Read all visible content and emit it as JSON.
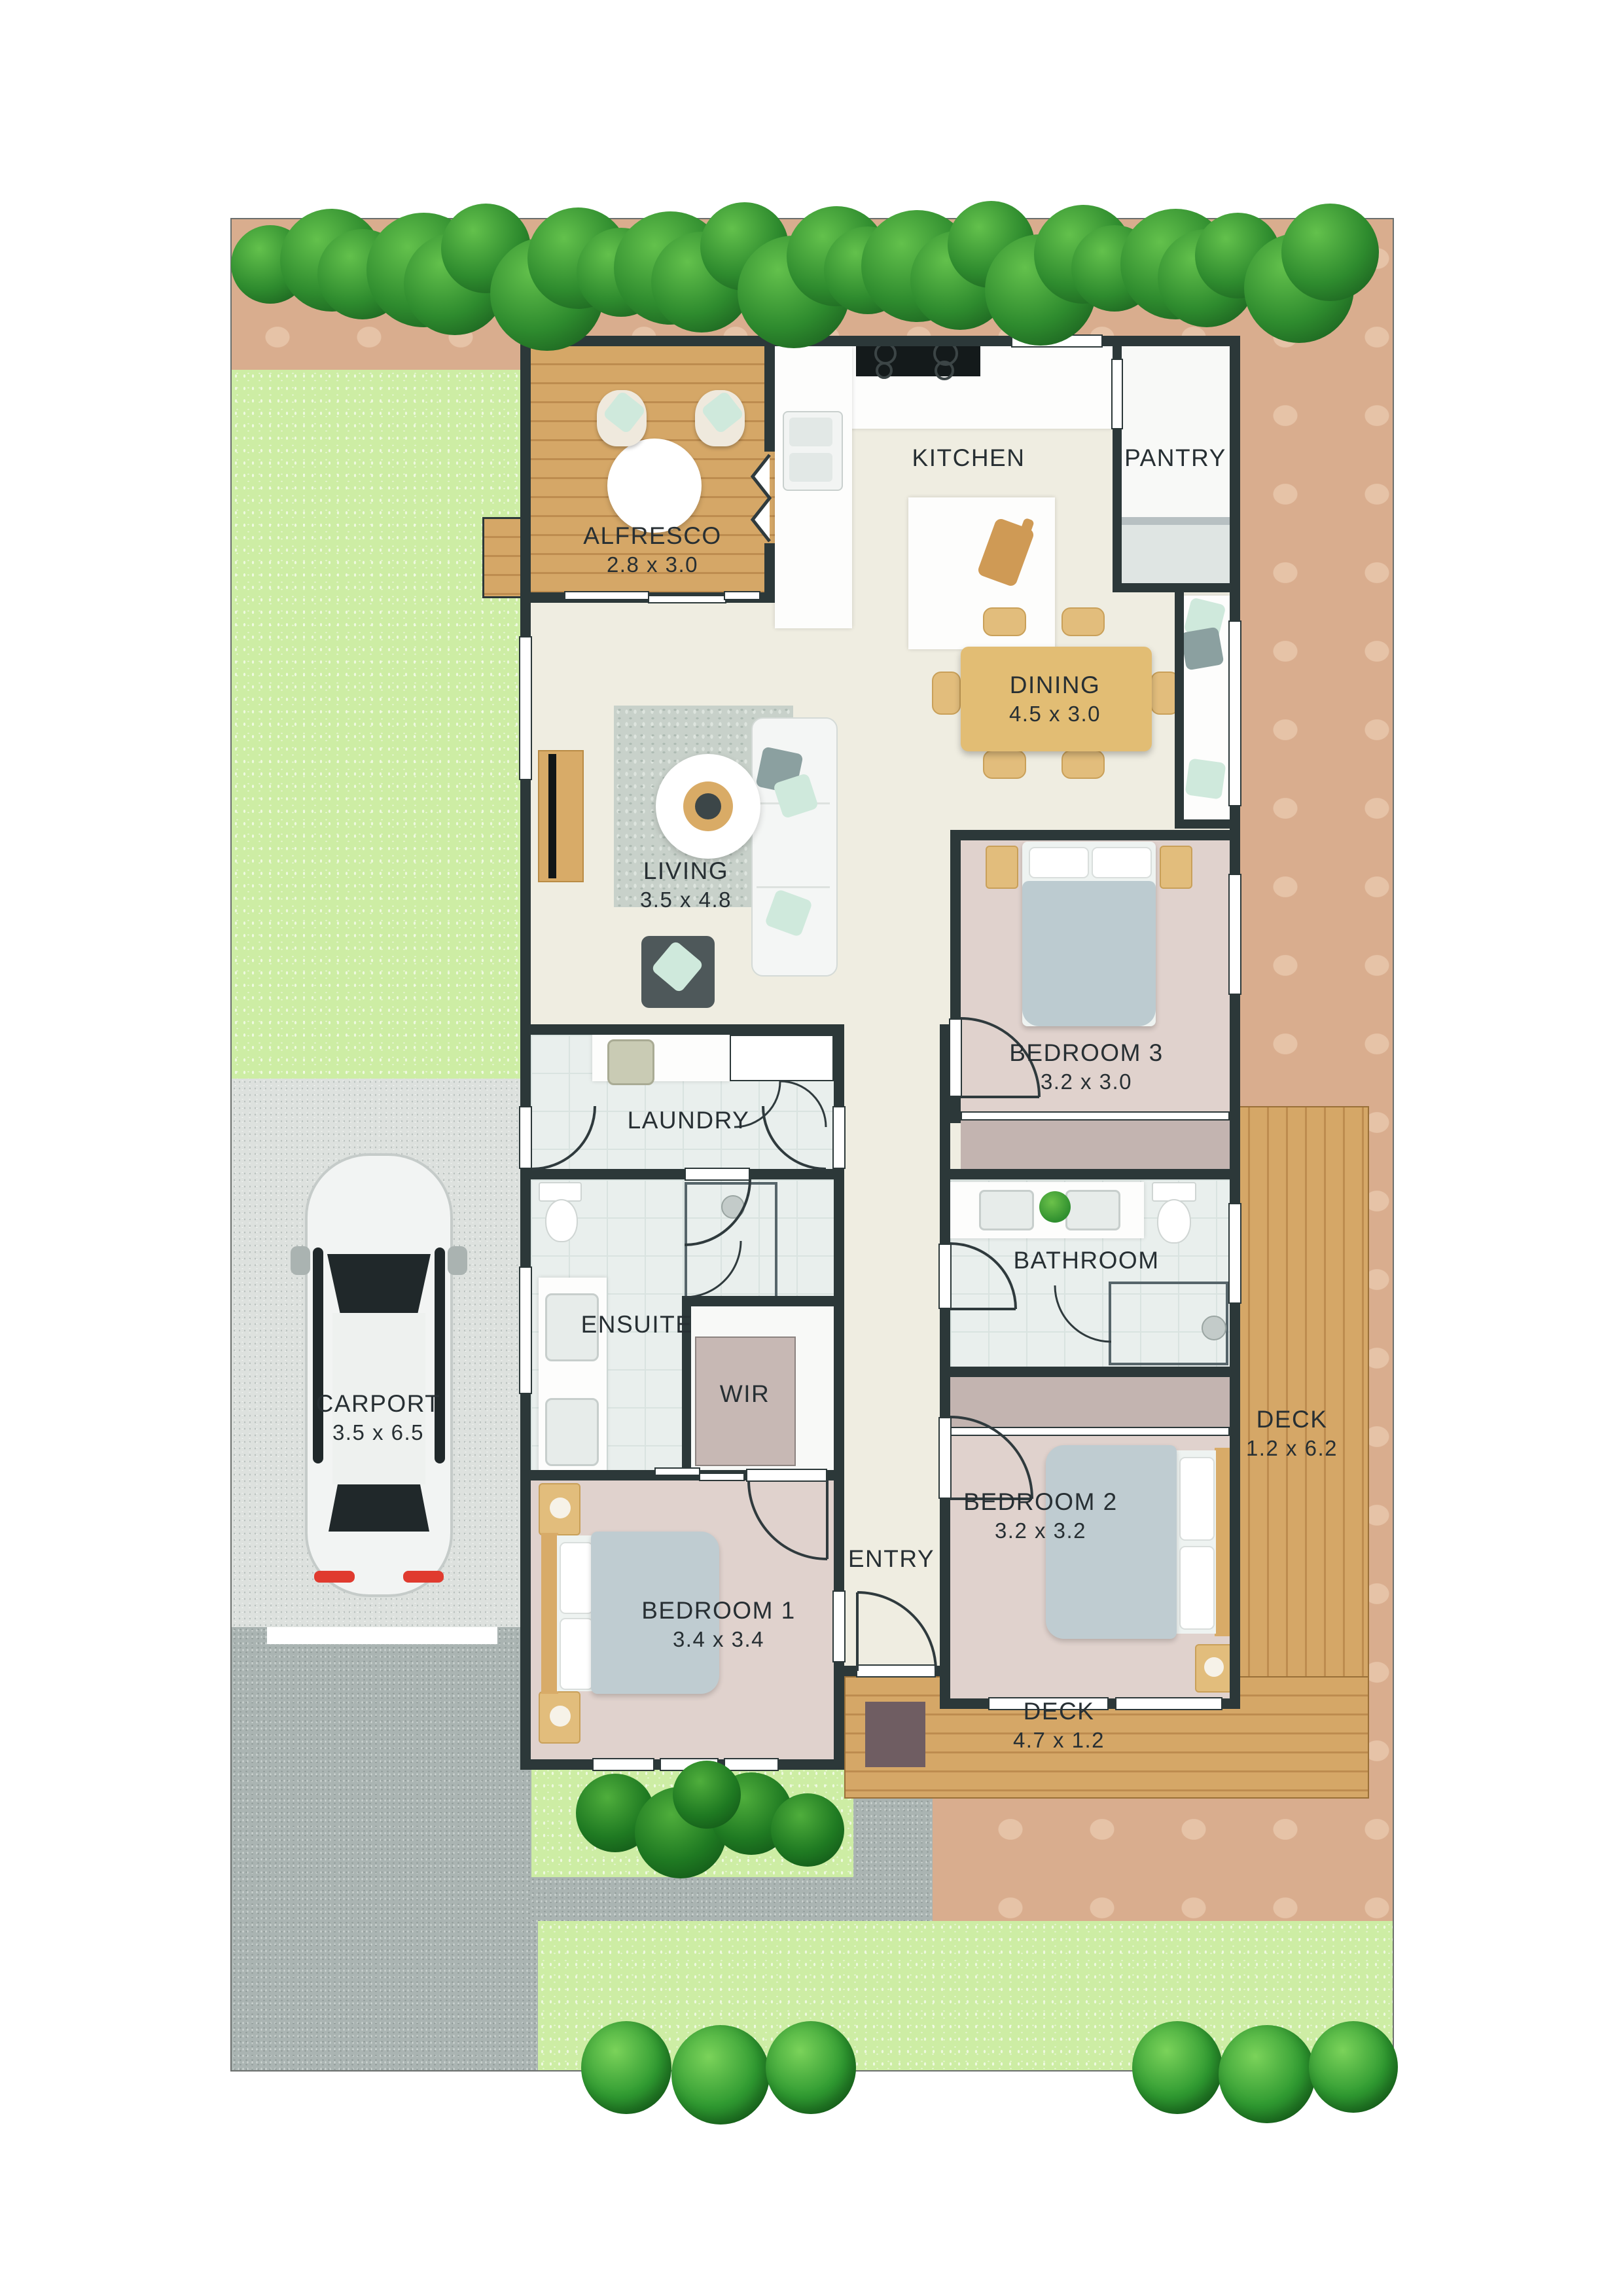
{
  "plan": {
    "type": "residential floor plan, top-down site view",
    "rooms": [
      {
        "name": "ALFRESCO",
        "dims": "2.8 x 3.0"
      },
      {
        "name": "KITCHEN",
        "dims": ""
      },
      {
        "name": "PANTRY",
        "dims": ""
      },
      {
        "name": "DINING",
        "dims": "4.5 x 3.0"
      },
      {
        "name": "LIVING",
        "dims": "3.5 x 4.8"
      },
      {
        "name": "BEDROOM 3",
        "dims": "3.2 x 3.0"
      },
      {
        "name": "LAUNDRY",
        "dims": ""
      },
      {
        "name": "BATHROOM",
        "dims": ""
      },
      {
        "name": "ENSUITE",
        "dims": ""
      },
      {
        "name": "WIR",
        "dims": ""
      },
      {
        "name": "CARPORT",
        "dims": "3.5 x 6.5"
      },
      {
        "name": "BEDROOM 1",
        "dims": "3.4 x 3.4"
      },
      {
        "name": "ENTRY",
        "dims": ""
      },
      {
        "name": "BEDROOM 2",
        "dims": "3.2 x 3.2"
      },
      {
        "name": "DECK",
        "dims": "1.2 x 6.2"
      },
      {
        "name": "DECK",
        "dims": "4.7 x 1.2"
      }
    ],
    "colors": {
      "wall": "#2c3839",
      "dirt": "#d9ad8e",
      "lawn": "#cdeda4",
      "deck_wood": "#d5a767",
      "bedroom_floor": "#e0d2cd",
      "tile_floor": "#e9efed",
      "living_floor": "#efede1",
      "robe": "#c3b4b0",
      "hedge_green": "#2e8b2e",
      "car_body": "#f2f4f3",
      "label_text": "#272f33"
    }
  },
  "decor": {
    "hedge_count": 26
  }
}
